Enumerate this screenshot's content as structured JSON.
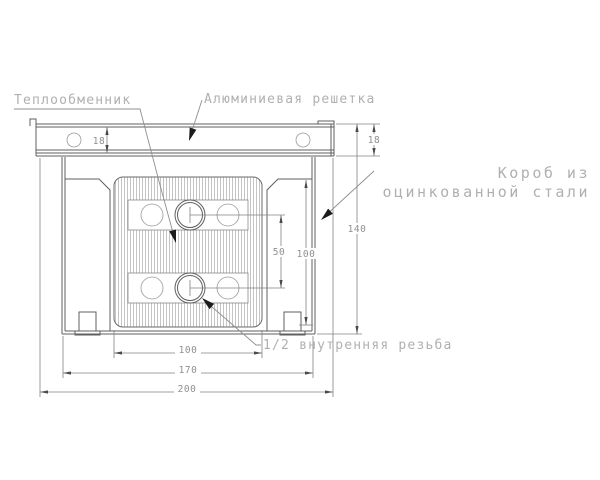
{
  "labels": {
    "heat_exchanger": "Теплообменник",
    "aluminum_grille": "Алюминиевая решетка",
    "box_line1": "Короб из",
    "box_line2": "оцинкованной стали",
    "thread": "1/2 внутренняя резьба"
  },
  "dimensions": {
    "grille_height_left": "18",
    "grille_height_right": "18",
    "overall_height": "140",
    "inner_height": "100",
    "pipe_spacing": "50",
    "exchanger_width": "100",
    "box_width": "170",
    "overall_width": "200"
  },
  "colors": {
    "line": "#5f5f5f",
    "dim_line": "#828282",
    "dim_text": "#8f8f8f",
    "label_text": "#b0b0b0",
    "arrow": "#1c1c1c",
    "hatch": "#bdbdbd",
    "background": "#ffffff"
  }
}
